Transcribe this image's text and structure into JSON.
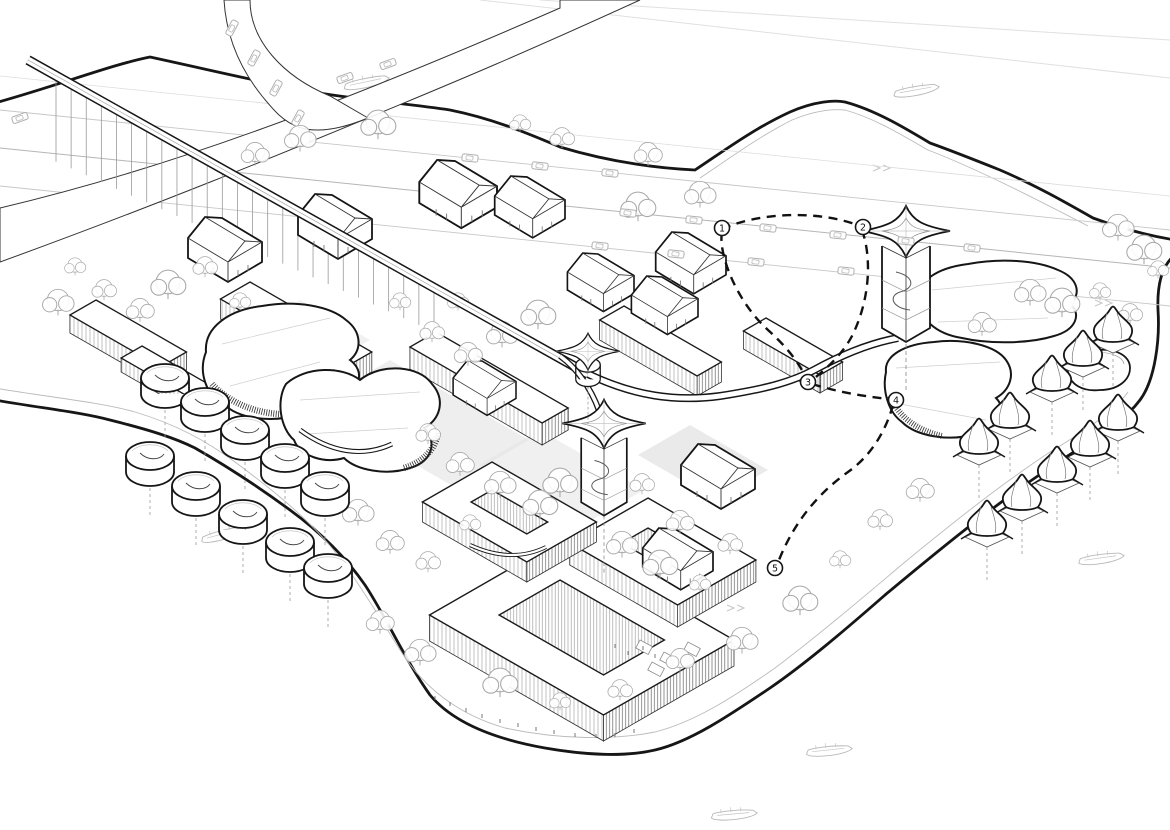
{
  "figure": {
    "kind": "architectural-axonometric-masterplan-drawing",
    "style": "black-and-white line drawing",
    "setting": "waterfront district surrounded by a lake, crossed by an elevated bridge and highway"
  },
  "palette": {
    "ink": "#161616",
    "line": "#333333",
    "soft": "#999999",
    "faint": "#c7c7c7",
    "paper": "#ffffff",
    "paving": "#e3e3e3",
    "hatch": "#555555"
  },
  "route": {
    "style": "bold dashed tour loop",
    "markers": [
      {
        "label": "1"
      },
      {
        "label": "2"
      },
      {
        "label": "3"
      },
      {
        "label": "4"
      },
      {
        "label": "5"
      }
    ]
  },
  "scene": {
    "features": [
      {
        "name": "elevated-bridge-viaduct",
        "count": 1
      },
      {
        "name": "star-canopy-tower",
        "count": 3
      },
      {
        "name": "drum-pavilion",
        "count": 10
      },
      {
        "name": "dome-pavilion",
        "count": 10
      },
      {
        "name": "gabled-house",
        "count": 10
      },
      {
        "name": "organic-blob-building",
        "count": 5
      },
      {
        "name": "courtyard-housing-block",
        "count": 9
      },
      {
        "name": "tree",
        "count": 56
      },
      {
        "name": "car",
        "count": 20
      },
      {
        "name": "boat",
        "count": 6
      },
      {
        "name": "route-marker",
        "count": 5
      }
    ]
  }
}
